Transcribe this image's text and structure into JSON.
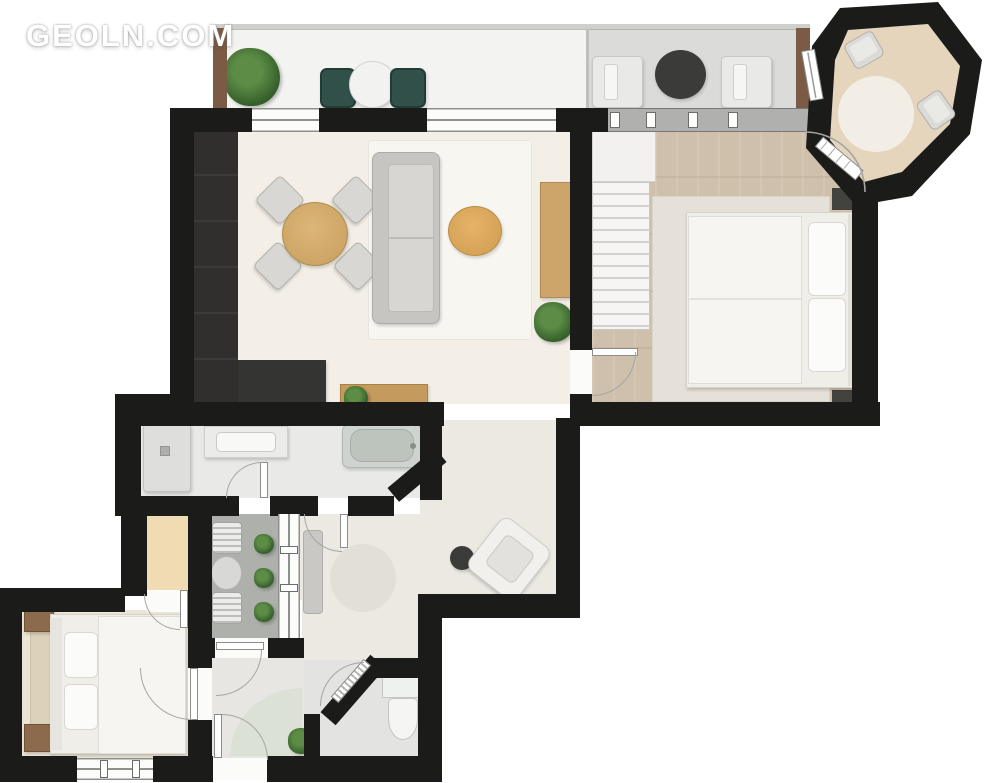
{
  "watermark": {
    "text": "GEOLN.COM"
  },
  "palette": {
    "wall": "#1b1b1a",
    "wood_floor": "#cfc0ab",
    "octagon_floor": "#e6d5bd",
    "living_floor": "#f3efe7",
    "hall_floor": "#ece9e3",
    "bathroom_floor": "#e9e9e7",
    "loggia_floor": "#aeb1ab",
    "balcony_left_floor": "#f3f3f1",
    "balcony_right_floor": "#dbdbd9",
    "closet": "#efdcb2",
    "bedroom_left_rug": "#dcd1b9",
    "dining_table_wood": "#d3ab6d",
    "sideboard_wood": "#c49a5e",
    "pouf": "#dca95f",
    "plant_green": "#35602b",
    "balcony_chair_green": "#31504a",
    "dark_furniture": "#343432",
    "nightstand_wood": "#8b6b4c"
  },
  "inventory": {
    "balcony": [
      "plant",
      "two green armchairs",
      "round white table",
      "two white chairs",
      "round dark table"
    ],
    "living_room": [
      "wardrobe",
      "dining table with four chairs",
      "sofa",
      "area rug",
      "round pouf",
      "tv unit",
      "wooden sideboard",
      "console",
      "plants"
    ],
    "bedroom": [
      "staircase",
      "double bed",
      "two nightstands",
      "area rug"
    ],
    "octagon_room": [
      "round rug",
      "two chairs",
      "window",
      "door"
    ],
    "bathroom": [
      "shower cabin",
      "vanity sink",
      "bathtub"
    ],
    "loggia": [
      "two striped chairs",
      "round table",
      "three plants"
    ],
    "hall": [
      "round rug",
      "console",
      "side table",
      "armchair"
    ],
    "wc": [
      "toilet"
    ],
    "vestibule": [
      "corner rug",
      "plant"
    ],
    "bedroom_2": [
      "double bed",
      "two nightstands",
      "area rug"
    ]
  }
}
